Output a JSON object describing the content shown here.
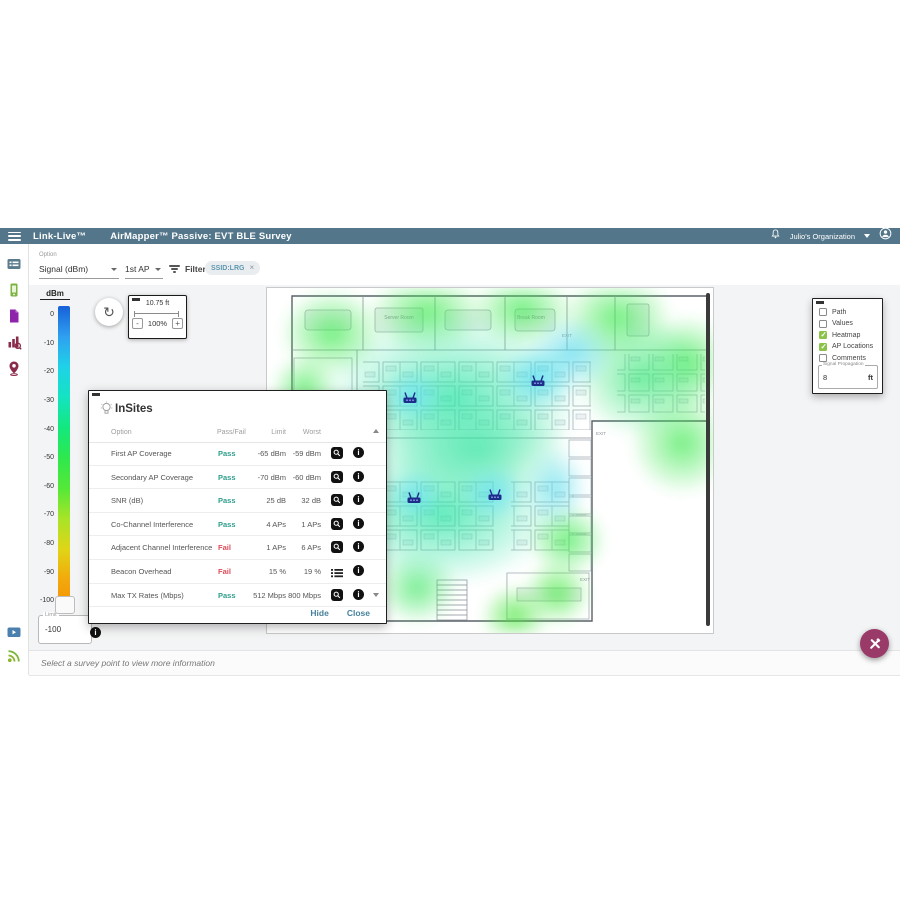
{
  "header": {
    "brand": "Link-Live™",
    "title": "AirMapper™ Passive: EVT BLE Survey",
    "org": "Julio's Organization"
  },
  "filter_bar": {
    "option_label": "Option",
    "option_value": "Signal (dBm)",
    "ap_value": "1st AP",
    "filters_label": "Filters",
    "chip": "SSID:LRG"
  },
  "scale": {
    "unit": "dBm",
    "ticks": [
      "0",
      "-10",
      "-20",
      "-30",
      "-40",
      "-50",
      "-60",
      "-70",
      "-80",
      "-90",
      "-100"
    ],
    "limit_label": "Limit",
    "limit_value": "-100"
  },
  "map_controls": {
    "scale_text": "10.75 ft",
    "zoom_out": "-",
    "zoom_value": "100%",
    "zoom_in": "+"
  },
  "map": {
    "labels": {
      "server_room": "Server Room",
      "break_room": "Break Room",
      "exit1": "EXIT",
      "exit2": "EXIT",
      "exit3": "EXIT"
    },
    "ap_positions": [
      {
        "x": 32.1,
        "y": 31.6
      },
      {
        "x": 60.8,
        "y": 26.7
      },
      {
        "x": 33.0,
        "y": 60.6
      },
      {
        "x": 51.1,
        "y": 59.7
      }
    ]
  },
  "insites": {
    "title": "InSites",
    "columns": [
      "Option",
      "Pass/Fail",
      "Limit",
      "Worst"
    ],
    "rows": [
      {
        "option": "First AP Coverage",
        "status": "Pass",
        "limit": "-65 dBm",
        "worst": "-59 dBm",
        "action": "search"
      },
      {
        "option": "Secondary AP Coverage",
        "status": "Pass",
        "limit": "-70 dBm",
        "worst": "-60 dBm",
        "action": "search"
      },
      {
        "option": "SNR (dB)",
        "status": "Pass",
        "limit": "25 dB",
        "worst": "32 dB",
        "action": "search"
      },
      {
        "option": "Co-Channel Interference",
        "status": "Pass",
        "limit": "4 APs",
        "worst": "1 APs",
        "action": "search"
      },
      {
        "option": "Adjacent Channel Interference",
        "status": "Fail",
        "limit": "1 APs",
        "worst": "6 APs",
        "action": "search"
      },
      {
        "option": "Beacon Overhead",
        "status": "Fail",
        "limit": "15 %",
        "worst": "19 %",
        "action": "list"
      },
      {
        "option": "Max TX Rates (Mbps)",
        "status": "Pass",
        "limit": "512 Mbps",
        "worst": "800 Mbps",
        "action": "search"
      }
    ],
    "hide_label": "Hide",
    "close_label": "Close"
  },
  "layers_panel": {
    "items": [
      {
        "label": "Path",
        "checked": false
      },
      {
        "label": "Values",
        "checked": false
      },
      {
        "label": "Heatmap",
        "checked": true
      },
      {
        "label": "AP Locations",
        "checked": true
      },
      {
        "label": "Comments",
        "checked": false
      }
    ],
    "signal_propagation_label": "Signal Propagation",
    "signal_propagation_value": "8",
    "signal_propagation_unit": "ft"
  },
  "status_bar": {
    "message": "Select a survey point to view more information"
  },
  "colors": {
    "header_bg": "#53768a",
    "pass": "#2d9d8a",
    "fail": "#e04a5a",
    "fab": "#993a69",
    "checkbox_checked": "#8bc34a",
    "heatmap_green": "#3de950",
    "heatmap_teal": "#2de4a5",
    "heatmap_cyan": "#46d8e8"
  }
}
